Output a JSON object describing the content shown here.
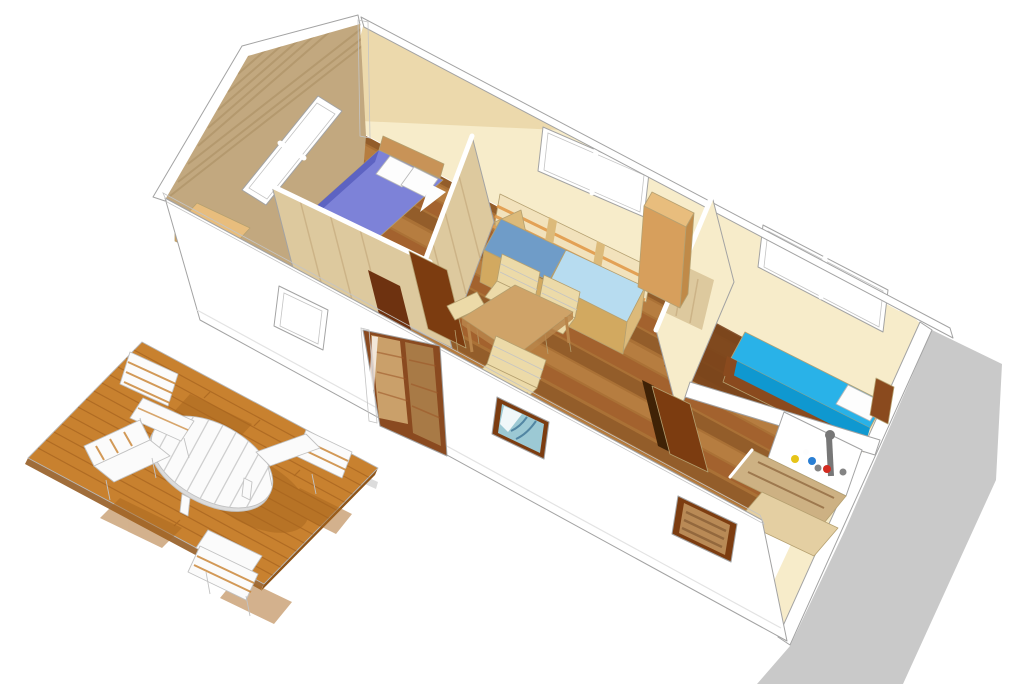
{
  "scene": {
    "type": "3d-floorplan-render",
    "rooms": ""
  },
  "colors": {
    "background": "#ffffff",
    "shadow_gray": "#c9c9c9",
    "shadow_gray_light": "#dcdcdc",
    "deck_wood": "#c8812f",
    "deck_side": "#8f5417",
    "deck_plank": "#9c5a1a",
    "deck_shadow": "#a8661e",
    "white_wall": "#ffffff",
    "cream_wall": "#f7ecca",
    "cream_shadow": "#e9d5a4",
    "gable_wood": "#c2a87f",
    "gable_streak": "#a58a5f",
    "partition_wood": "#ddc99e",
    "partition_streak": "#c2a678",
    "floor_base": "#aa7136",
    "floor_dark": "#7c4a1f",
    "floor_light": "#c28a4a",
    "floor_red": "#9c5526",
    "hall_floor": "#6e3c16",
    "bedroom2_floor": "#7a441b",
    "door_brown": "#7c3c10",
    "door_brown2": "#6e3210",
    "door_dark": "#3f2206",
    "glass": "#eef4f8",
    "frame_white": "#ffffff",
    "bed_purple": "#7d82d8",
    "bed_purple_dark": "#5a5fc0",
    "pillow_white": "#fdfdfd",
    "bed_cyan": "#29b2e8",
    "bed_cyan_dark": "#0f98d0",
    "bed_frame_wood": "#8a4a1e",
    "headboard_wood": "#c89357",
    "sofa_blue_dark": "#6f9cc8",
    "sofa_blue_light": "#b7dcf0",
    "sofa_frame": "#dcba7a",
    "sofa_front": "#d2a960",
    "stripe_orange": "#e29a4a",
    "stripe_cream": "#f2e2bc",
    "cabinet_wood": "#d79f5c",
    "cabinet_side": "#c08a48",
    "cabinet_top": "#e8bd7d",
    "table_wood": "#cfa368",
    "table_leg": "#b9854a",
    "chair_cream": "#ecdaa8",
    "vanity_wood": "#cdb183",
    "vanity_panel": "#e4cfa2",
    "sink_white": "#ffffff",
    "faucet_gray": "#777777",
    "bottle_yellow": "#e6c418",
    "bottle_blue": "#2a7fd4",
    "bottle_red": "#d22b20",
    "curtain_gray": "#ccd5d8",
    "curtain_teal": "#9cc9d4",
    "curtain_teal_dark": "#4a7f9e",
    "shutter_wood": "#b98a56",
    "shutter_dark": "#8a6038",
    "door_glass_wood": "#caa06a",
    "door_glass_wood_dark": "#a87a46",
    "slider_frame": "#8a4a20",
    "outdoor_white": "#fbfbfb"
  }
}
